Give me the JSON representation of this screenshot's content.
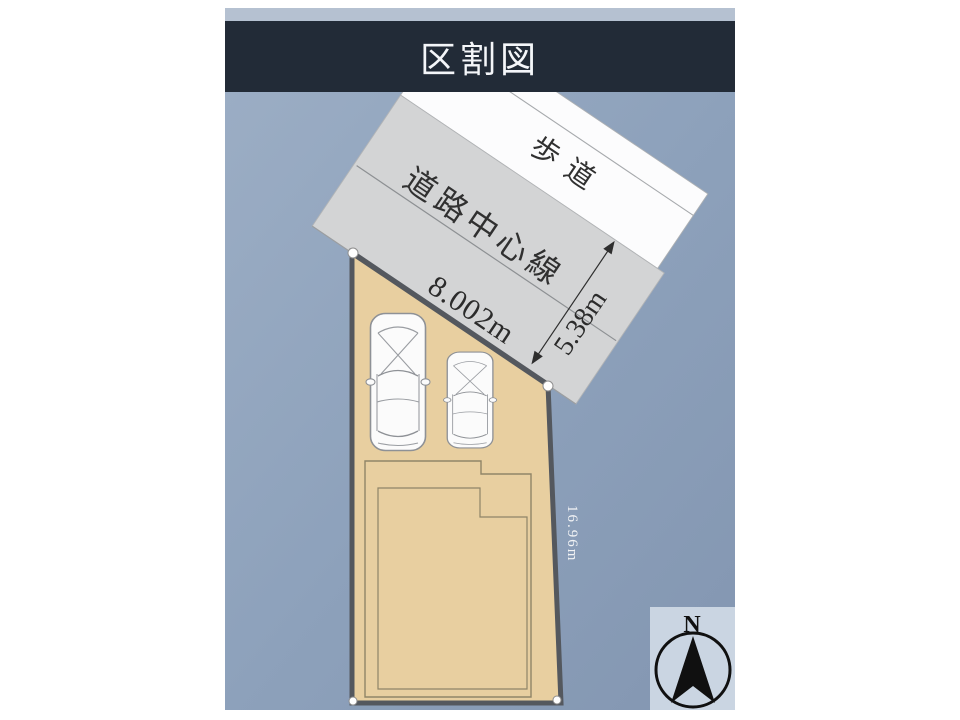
{
  "page": {
    "title": "区割図"
  },
  "diagram": {
    "labels": {
      "sidewalk": "歩道",
      "road_center_line": "道路中心線",
      "frontage": "8.002m",
      "road_width": "5.38m",
      "side_dimension": "16.96m"
    },
    "compass": {
      "north": "N"
    },
    "colors": {
      "title_bar": "#222b37",
      "background": "#8da1bb",
      "road_gray": "#d3d4d5",
      "sidewalk_white": "#fcfcfd",
      "plot_tan": "#e8cfa0",
      "plot_border": "#54585e",
      "compass_box": "#cad5e2"
    }
  }
}
